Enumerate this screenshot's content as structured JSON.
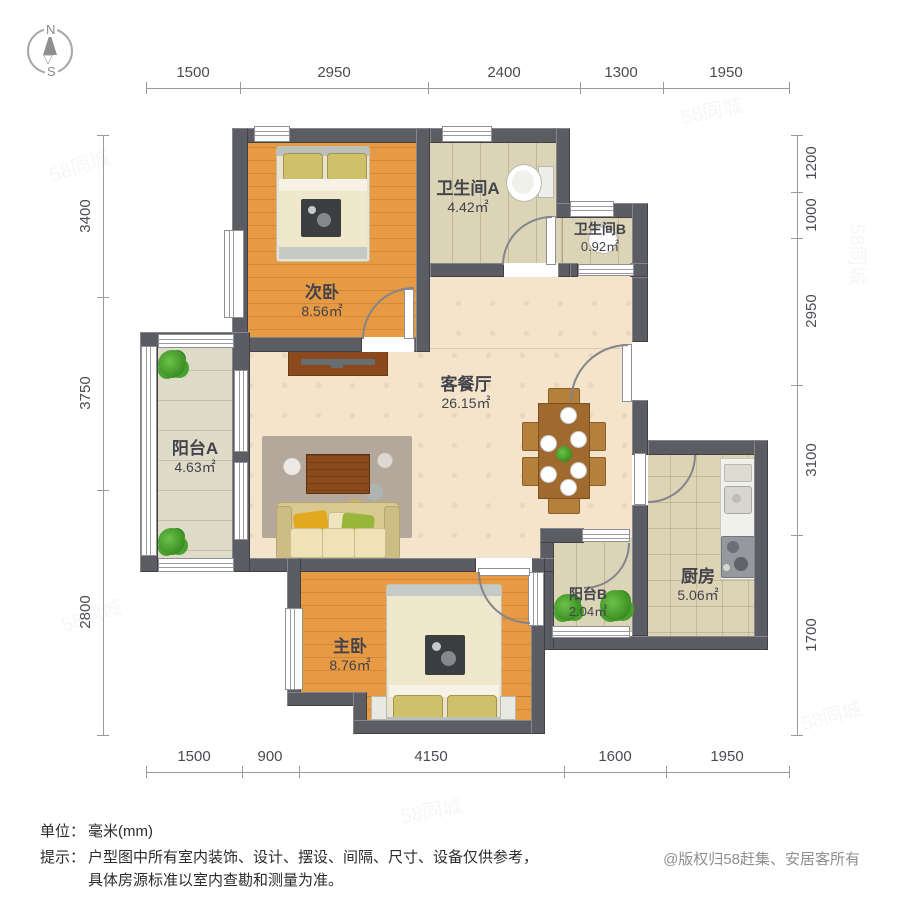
{
  "compass": {
    "north": "N",
    "south": "S"
  },
  "dimensions": {
    "top": [
      "1500",
      "2950",
      "2400",
      "1300",
      "1950"
    ],
    "bottom": [
      "1500",
      "900",
      "4150",
      "1600",
      "1950"
    ],
    "left": [
      "3400",
      "3750",
      "2800"
    ],
    "right": [
      "1200",
      "1000",
      "2950",
      "3100",
      "1700"
    ]
  },
  "rooms": {
    "second_bedroom": {
      "name": "次卧",
      "area": "8.56㎡"
    },
    "bathroom_a": {
      "name": "卫生间A",
      "area": "4.42㎡"
    },
    "bathroom_b": {
      "name": "卫生间B",
      "area": "0.92㎡"
    },
    "living_dining": {
      "name": "客餐厅",
      "area": "26.15㎡"
    },
    "balcony_a": {
      "name": "阳台A",
      "area": "4.63㎡"
    },
    "balcony_b": {
      "name": "阳台B",
      "area": "2.04㎡"
    },
    "kitchen": {
      "name": "厨房",
      "area": "5.06㎡"
    },
    "master_bedroom": {
      "name": "主卧",
      "area": "8.76㎡"
    }
  },
  "footer": {
    "unit_label": "单位：",
    "unit_value": "毫米(mm)",
    "tip_label": "提示：",
    "tip_line1": "户型图中所有室内装饰、设计、摆设、间隔、尺寸、设备仅供参考，",
    "tip_line2": "具体房源标准以室内查勘和测量为准。",
    "copyright": "@版权归58赶集、安居客所有"
  },
  "watermark": "58同城"
}
